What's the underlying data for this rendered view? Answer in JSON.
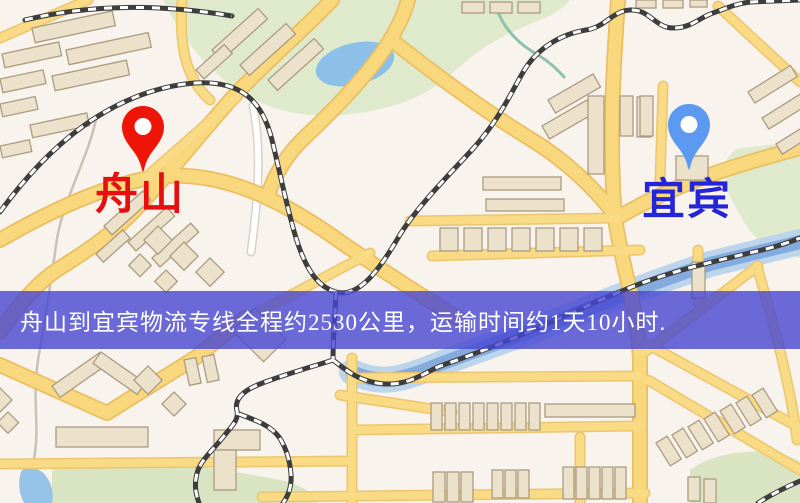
{
  "banner": {
    "text": "舟山到宜宾物流专线全程约2530公里，运输时间约1天10小时.",
    "bg": "rgba(70,70,210,0.8)",
    "text_color": "#ffffff"
  },
  "map": {
    "markers": [
      {
        "id": "zhoushan",
        "label": "舟山",
        "pin_color": "#ee1408",
        "label_color": "#e60e0e",
        "tip_x": 143,
        "tip_y": 172,
        "label_x": 95,
        "label_y": 172
      },
      {
        "id": "yibin",
        "label": "宜宾",
        "pin_color": "#5b9af0",
        "label_color": "#2424d8",
        "tip_x": 689,
        "tip_y": 170,
        "label_x": 642,
        "label_y": 177
      }
    ],
    "colors": {
      "background": "#f8f3ec",
      "park": "#dfeacd",
      "water": "#8cc0e9",
      "road": "#f8d77d",
      "railway": "#3d3d3d",
      "building": "#ece2cb"
    }
  }
}
